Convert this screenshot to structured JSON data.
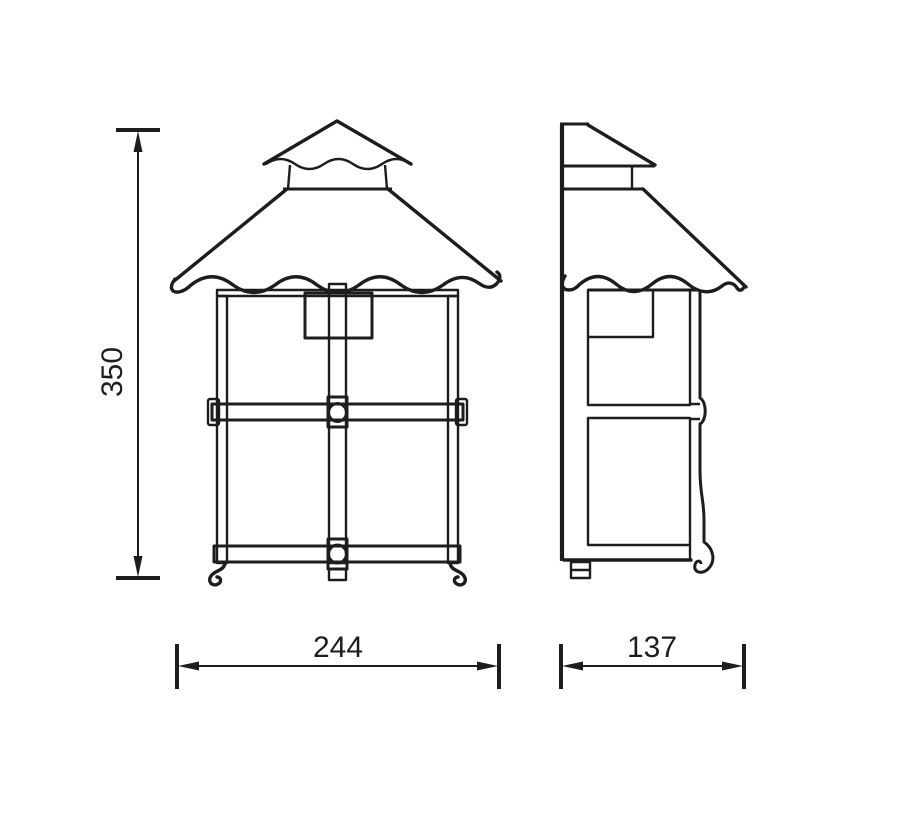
{
  "canvas": {
    "background": "#ffffff",
    "line_color": "#1d1d1d",
    "width_px": 900,
    "height_px": 824
  },
  "views": {
    "front": {
      "id": "front-view"
    },
    "side": {
      "id": "side-view"
    }
  },
  "dimension_labels": {
    "height": "350",
    "width": "244",
    "depth": "137"
  }
}
